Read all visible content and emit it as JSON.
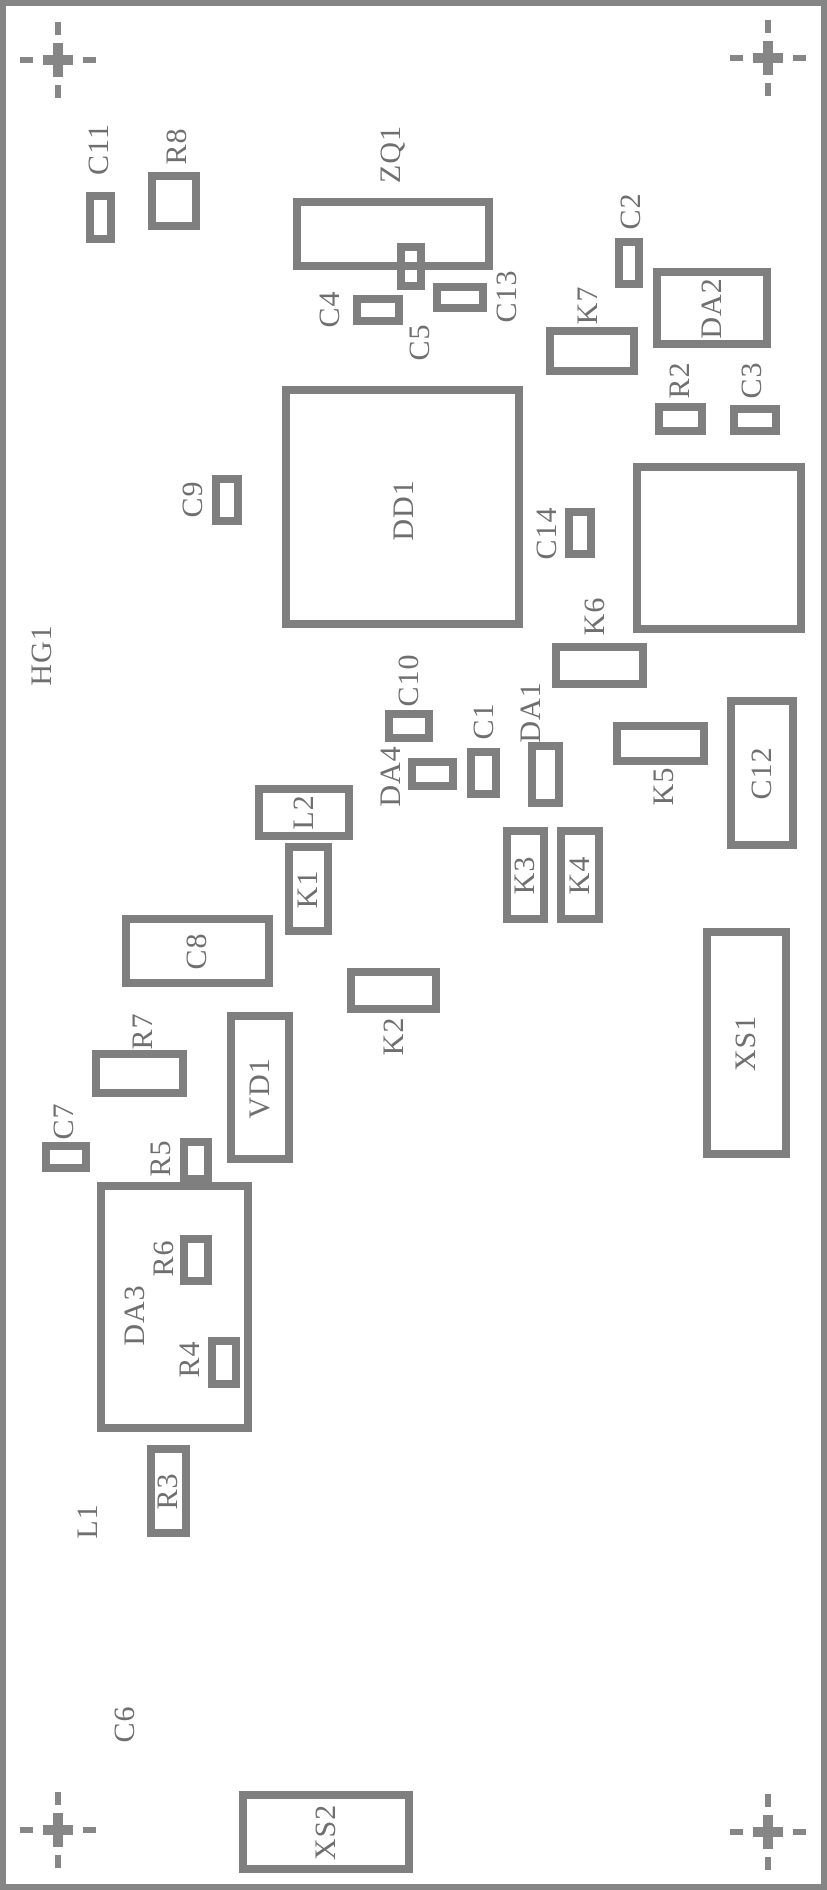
{
  "diagram": {
    "type": "pcb-assembly-drawing",
    "board_ref": "HG1",
    "colors": {
      "background": "#ffffff",
      "outline_gray": "#7f7f7f",
      "text_gray": "#6f6f6f",
      "border_gray": "#858585"
    },
    "fiducials": [
      {
        "name": "fiducial-top-left",
        "cx": 58,
        "cy": 60
      },
      {
        "name": "fiducial-top-right",
        "cx": 768,
        "cy": 58
      },
      {
        "name": "fiducial-bottom-left",
        "cx": 58,
        "cy": 1830
      },
      {
        "name": "fiducial-bottom-right",
        "cx": 768,
        "cy": 1832
      }
    ],
    "components": [
      {
        "ref": "C11",
        "x": 86,
        "y": 192,
        "w": 29,
        "h": 51,
        "label": {
          "cx": 99,
          "cy": 149,
          "inside": false
        }
      },
      {
        "ref": "R8",
        "x": 148,
        "y": 172,
        "w": 52,
        "h": 58,
        "label": {
          "cx": 177,
          "cy": 146,
          "inside": false
        }
      },
      {
        "ref": "ZQ1",
        "x": 293,
        "y": 198,
        "w": 200,
        "h": 72,
        "label": {
          "cx": 391,
          "cy": 154,
          "inside": false
        }
      },
      {
        "ref": "C5",
        "x": 397,
        "y": 243,
        "w": 28,
        "h": 47,
        "label": {
          "cx": 420,
          "cy": 342,
          "inside": false
        }
      },
      {
        "ref": "C4",
        "x": 353,
        "y": 295,
        "w": 50,
        "h": 30,
        "label": {
          "cx": 330,
          "cy": 309,
          "inside": false
        }
      },
      {
        "ref": "C13",
        "x": 433,
        "y": 283,
        "w": 54,
        "h": 29,
        "label": {
          "cx": 507,
          "cy": 296,
          "inside": false
        }
      },
      {
        "ref": "C2",
        "x": 615,
        "y": 238,
        "w": 28,
        "h": 50,
        "label": {
          "cx": 631,
          "cy": 211,
          "inside": false
        }
      },
      {
        "ref": "DA2",
        "x": 653,
        "y": 268,
        "w": 118,
        "h": 80,
        "label": {
          "cx": 712,
          "cy": 308,
          "inside": true
        }
      },
      {
        "ref": "K7",
        "x": 546,
        "y": 327,
        "w": 92,
        "h": 48,
        "label": {
          "cx": 588,
          "cy": 305,
          "inside": false
        }
      },
      {
        "ref": "R2",
        "x": 655,
        "y": 403,
        "w": 51,
        "h": 32,
        "label": {
          "cx": 680,
          "cy": 380,
          "inside": false
        }
      },
      {
        "ref": "C3",
        "x": 730,
        "y": 405,
        "w": 50,
        "h": 30,
        "label": {
          "cx": 752,
          "cy": 380,
          "inside": false
        }
      },
      {
        "ref": "DD1",
        "x": 282,
        "y": 386,
        "w": 241,
        "h": 242,
        "label": {
          "cx": 404,
          "cy": 510,
          "inside": true
        }
      },
      {
        "ref": "C9",
        "x": 212,
        "y": 475,
        "w": 30,
        "h": 50,
        "label": {
          "cx": 193,
          "cy": 499,
          "inside": false
        }
      },
      {
        "ref": "C14",
        "x": 565,
        "y": 508,
        "w": 30,
        "h": 50,
        "label": {
          "cx": 547,
          "cy": 533,
          "inside": false
        }
      },
      {
        "ref": "",
        "x": 633,
        "y": 463,
        "w": 172,
        "h": 170,
        "label": null
      },
      {
        "ref": "K6",
        "x": 552,
        "y": 643,
        "w": 95,
        "h": 45,
        "label": {
          "cx": 595,
          "cy": 616,
          "inside": false
        }
      },
      {
        "ref": "C10",
        "x": 385,
        "y": 710,
        "w": 48,
        "h": 32,
        "label": {
          "cx": 409,
          "cy": 680,
          "inside": false
        }
      },
      {
        "ref": "DA4",
        "x": 408,
        "y": 758,
        "w": 49,
        "h": 32,
        "label": {
          "cx": 391,
          "cy": 776,
          "inside": false
        }
      },
      {
        "ref": "C1",
        "x": 467,
        "y": 748,
        "w": 33,
        "h": 50,
        "label": {
          "cx": 484,
          "cy": 721,
          "inside": false
        }
      },
      {
        "ref": "DA1",
        "x": 528,
        "y": 742,
        "w": 35,
        "h": 65,
        "label": {
          "cx": 531,
          "cy": 712,
          "inside": false
        }
      },
      {
        "ref": "K5",
        "x": 613,
        "y": 722,
        "w": 95,
        "h": 43,
        "label": {
          "cx": 664,
          "cy": 786,
          "inside": false
        }
      },
      {
        "ref": "C12",
        "x": 727,
        "y": 697,
        "w": 70,
        "h": 152,
        "label": {
          "cx": 762,
          "cy": 773,
          "inside": true
        }
      },
      {
        "ref": "L2",
        "x": 255,
        "y": 785,
        "w": 98,
        "h": 55,
        "label": {
          "cx": 304,
          "cy": 812,
          "inside": true
        }
      },
      {
        "ref": "K1",
        "x": 285,
        "y": 843,
        "w": 47,
        "h": 92,
        "label": {
          "cx": 308,
          "cy": 889,
          "inside": true
        }
      },
      {
        "ref": "C8",
        "x": 122,
        "y": 915,
        "w": 151,
        "h": 72,
        "label": {
          "cx": 197,
          "cy": 951,
          "inside": true
        }
      },
      {
        "ref": "K3",
        "x": 503,
        "y": 827,
        "w": 45,
        "h": 96,
        "label": {
          "cx": 525,
          "cy": 875,
          "inside": true
        }
      },
      {
        "ref": "K4",
        "x": 557,
        "y": 827,
        "w": 46,
        "h": 96,
        "label": {
          "cx": 580,
          "cy": 875,
          "inside": true
        }
      },
      {
        "ref": "K2",
        "x": 347,
        "y": 968,
        "w": 93,
        "h": 45,
        "label": {
          "cx": 394,
          "cy": 1036,
          "inside": false
        }
      },
      {
        "ref": "R7",
        "x": 92,
        "y": 1050,
        "w": 95,
        "h": 47,
        "label": {
          "cx": 143,
          "cy": 1031,
          "inside": false
        }
      },
      {
        "ref": "VD1",
        "x": 227,
        "y": 1012,
        "w": 66,
        "h": 151,
        "label": {
          "cx": 260,
          "cy": 1088,
          "inside": true
        }
      },
      {
        "ref": "C7",
        "x": 42,
        "y": 1142,
        "w": 48,
        "h": 30,
        "label": {
          "cx": 64,
          "cy": 1121,
          "inside": false
        }
      },
      {
        "ref": "R5",
        "x": 180,
        "y": 1138,
        "w": 32,
        "h": 45,
        "label": {
          "cx": 161,
          "cy": 1158,
          "inside": false
        }
      },
      {
        "ref": "DA3",
        "x": 97,
        "y": 1182,
        "w": 155,
        "h": 250,
        "label": {
          "cx": 135,
          "cy": 1315,
          "inside": true
        }
      },
      {
        "ref": "R6",
        "x": 180,
        "y": 1235,
        "w": 32,
        "h": 50,
        "label": {
          "cx": 164,
          "cy": 1258,
          "inside": false
        }
      },
      {
        "ref": "R4",
        "x": 208,
        "y": 1337,
        "w": 32,
        "h": 51,
        "label": {
          "cx": 190,
          "cy": 1359,
          "inside": false
        }
      },
      {
        "ref": "R3",
        "x": 147,
        "y": 1445,
        "w": 43,
        "h": 92,
        "label": {
          "cx": 168,
          "cy": 1491,
          "inside": true
        }
      },
      {
        "ref": "XS1",
        "x": 703,
        "y": 928,
        "w": 87,
        "h": 230,
        "label": {
          "cx": 746,
          "cy": 1043,
          "inside": true
        }
      },
      {
        "ref": "XS2",
        "x": 239,
        "y": 1791,
        "w": 174,
        "h": 82,
        "label": {
          "cx": 326,
          "cy": 1832,
          "inside": true
        }
      }
    ],
    "text_labels": [
      {
        "text": "HG1",
        "cx": 42,
        "cy": 655
      },
      {
        "text": "L1",
        "cx": 88,
        "cy": 1521
      },
      {
        "text": "C6",
        "cx": 125,
        "cy": 1724
      }
    ]
  }
}
